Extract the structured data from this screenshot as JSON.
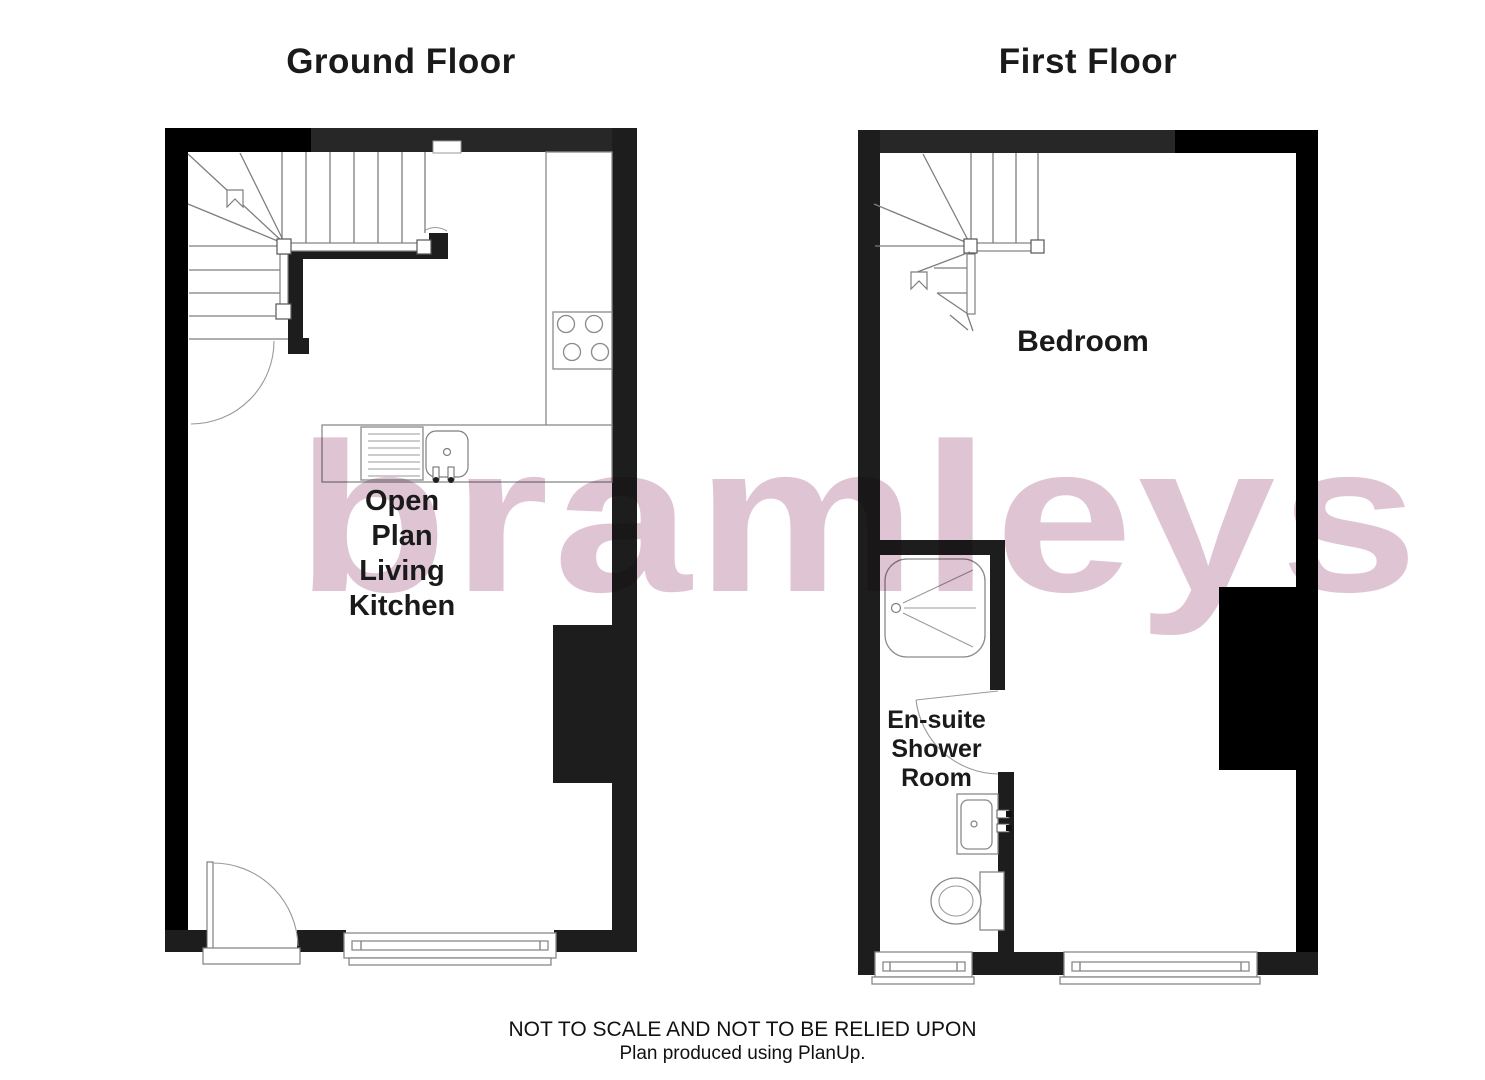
{
  "titles": {
    "ground_floor": "Ground Floor",
    "first_floor": "First Floor"
  },
  "rooms": {
    "open_plan_living_kitchen": "Open\nPlan\nLiving\nKitchen",
    "bedroom": "Bedroom",
    "ensuite_shower_room": "En-suite\nShower\nRoom"
  },
  "watermark": {
    "text": "bramleys",
    "color": "#dfc5d4"
  },
  "footer": {
    "disclaimer": "NOT TO SCALE AND NOT TO BE RELIED UPON",
    "credit": "Plan produced using PlanUp."
  },
  "colors": {
    "wall": "#1d1d1d",
    "wall_dark": "#000000",
    "line_gray": "#8a8a8a",
    "background": "#ffffff"
  },
  "fixtures": {
    "ground_floor": [
      "staircase",
      "stair-direction-arrow",
      "tall-kitchen-unit",
      "hob",
      "kitchen-counter",
      "sink-with-drainer",
      "chimney-breast",
      "entrance-door-swing",
      "window"
    ],
    "first_floor": [
      "staircase",
      "stair-direction-arrow",
      "shower-tray",
      "ensuite-door-swing",
      "wash-basin",
      "toilet",
      "chimney-breast",
      "ensuite-window",
      "bedroom-window"
    ]
  }
}
